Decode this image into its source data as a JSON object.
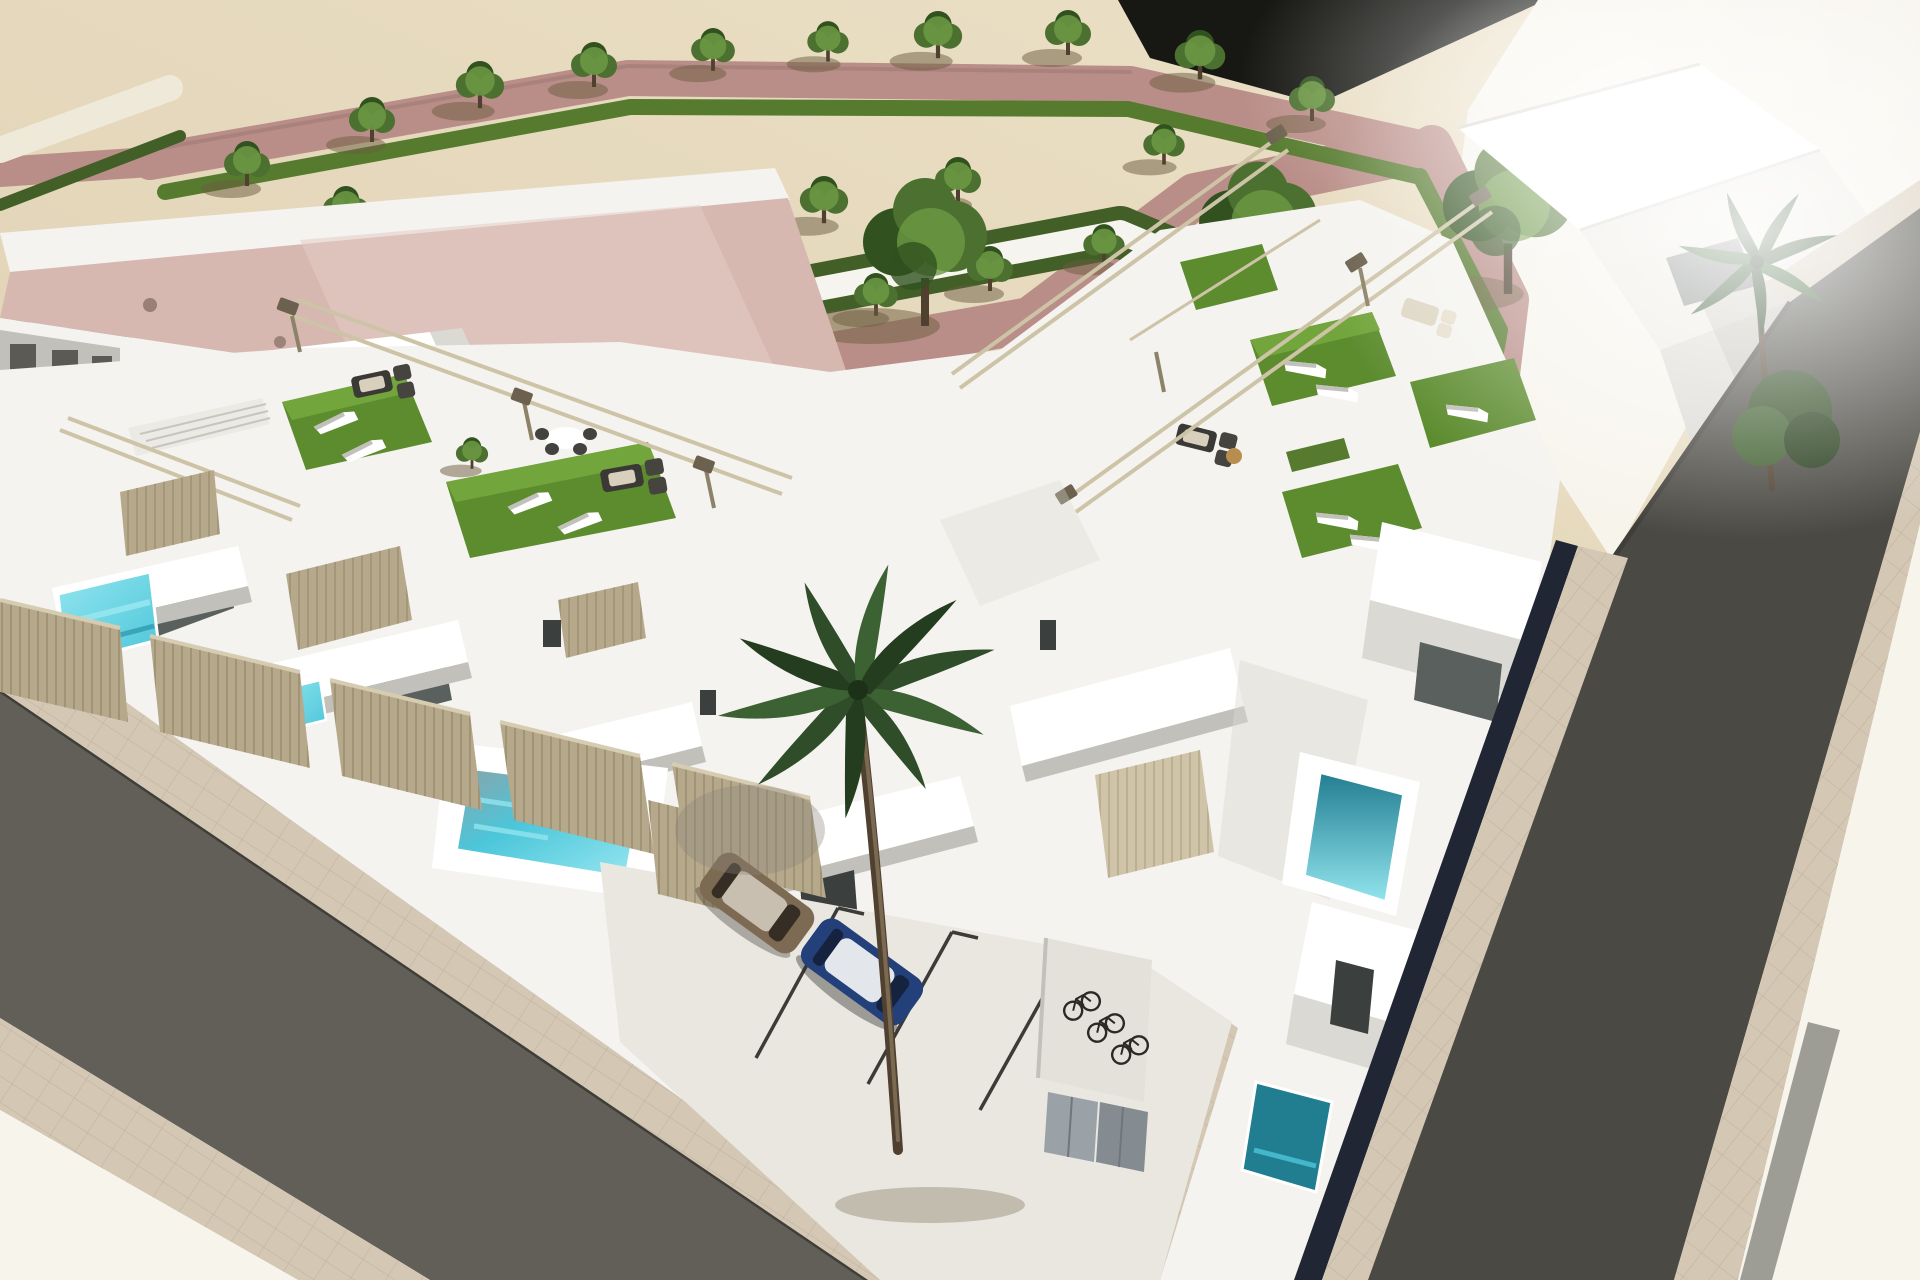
{
  "meta": {
    "type": "3D architectural rendering",
    "view": "aerial corner perspective",
    "description": "Aerial 3D render of a modern white townhouse development on a corner plot: rooftop solariums with artificial turf and sun loungers, private plunge pools, beige slatted fences, a landscaped park with zigzag hedges and trees, pink and white walkways, two asphalt streets, a parking court with two cars and a bicycle shelter, and palm trees."
  },
  "scene": {
    "setting": "new-build Mediterranean residential complex beside a formal park",
    "lighting": "bright midday sun, strong overexposure to the upper right, shadows falling to the lower left",
    "townhouse_rows": 2,
    "visible_units": 9,
    "rooftop_solariums": 6,
    "plunge_pools": 6,
    "park_trees": 24,
    "large_trees": 3,
    "palm_trees": 2,
    "parked_cars": [
      "bronze compact car",
      "dark blue hatchback"
    ],
    "bicycles": 3,
    "parking_stalls": 3,
    "roads": [
      "asphalt street lower left",
      "asphalt street on the right"
    ],
    "park_features": [
      "zigzag clipped hedges",
      "white gravel paths",
      "dusty-pink walkways",
      "sand-coloured ground"
    ]
  },
  "colors": {
    "sand": "#dfd0b1",
    "sandLight": "#ece1c8",
    "bright": "#f7f4ec",
    "pink": "#ba8e88",
    "pinkDark": "#a47d78",
    "roofPink": "#d6b8b0",
    "roofPinkLight": "#e4ccc4",
    "hedge": "#425f27",
    "hedgeLit": "#567b2e",
    "leaf": "#4c7030",
    "leafLit": "#6d9a44",
    "leafDark": "#31511f",
    "trunk": "#4f4030",
    "shadow": "#6b5b40",
    "white": "#f4f3ef",
    "white2": "#ffffff",
    "shade": "#dbd9d3",
    "shade2": "#c2c0ba",
    "shade3": "#a8a7a1",
    "glass": "#59605d",
    "glassDark": "#3b403f",
    "glassLit": "#9aa29e",
    "turf": "#5d8c2f",
    "turfLit": "#72a53c",
    "turfDark": "#476f28",
    "pool": "#4cc6da",
    "poolLit": "#92e5ee",
    "poolDark": "#2b93a9",
    "poolDeep": "#217d90",
    "fence": "#b6a88b",
    "fenceSlat": "#8f8165",
    "fenceLit": "#d6ccb2",
    "beam": "#cdc3a6",
    "beamDark": "#8c8268",
    "cap": "#6b614e",
    "roadL": "#615f58",
    "roadR": "#4a4943",
    "kerb": "#3f3e39",
    "walk": "#d4c8b5",
    "grout": "#bcae99",
    "concrete": "#e9e7e0",
    "line": "#3c3b37",
    "navy": "#202633",
    "carBody": "#23407a",
    "carRoof": "#e3e6ea",
    "carGlass": "#16233f",
    "car2Body": "#7d6a52",
    "car2Roof": "#c9bfb0",
    "car2Glass": "#362e24",
    "bike": "#2b2926",
    "door": "#9aa2a8",
    "door2": "#848c92",
    "stripe": "#8e8d86",
    "blackArea": "#171714"
  }
}
